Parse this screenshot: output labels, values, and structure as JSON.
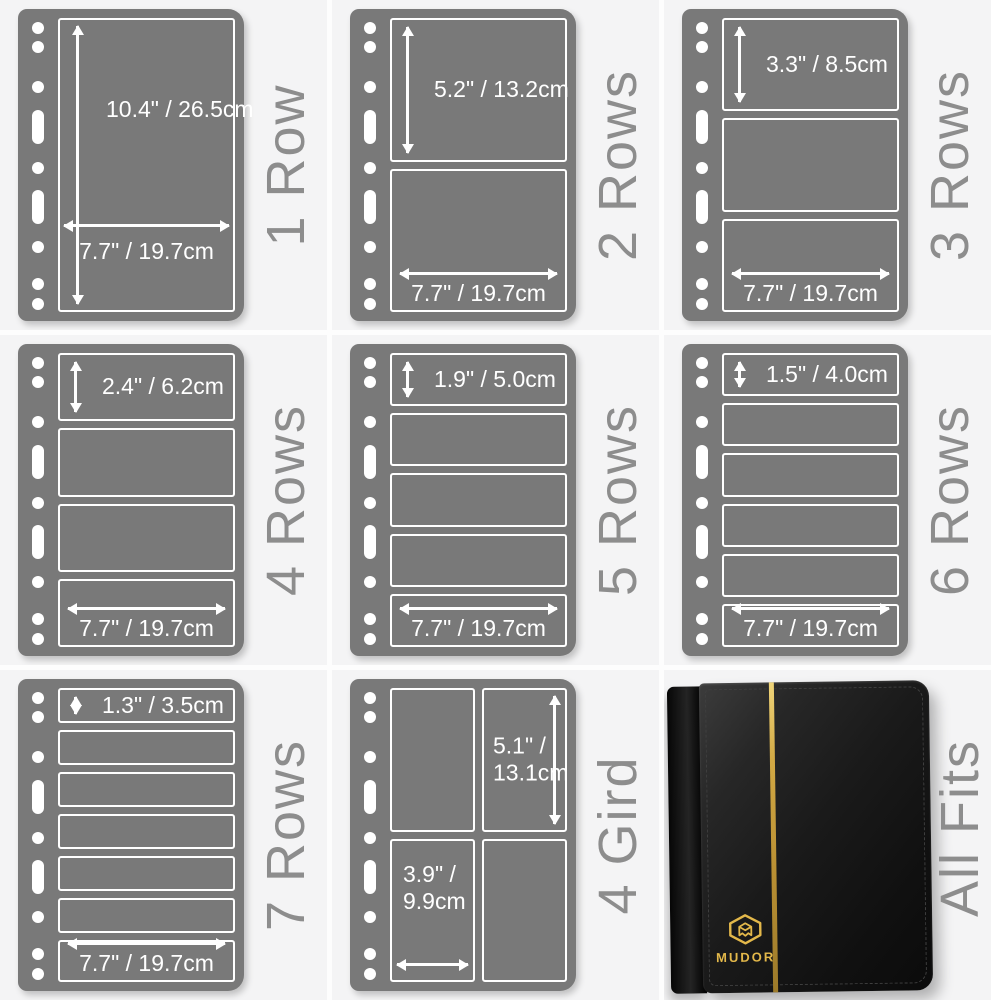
{
  "image_type": "stamp pocket page size infographic",
  "colors": {
    "page_gray": "#797979",
    "pocket_outline": "#ffffff",
    "measure_text": "#ffffff",
    "side_label_gray": "#8d8d8d",
    "tile_background": "#f4f4f5",
    "binder_black": "#141414",
    "binder_gold": "#e3b84a"
  },
  "icons": {
    "dimension_arrow": "white double-headed arrow",
    "punch_hole": "white binder punch hole (circle / slot)",
    "brand_logo": "gold isometric cube monogram"
  },
  "panels": [
    {
      "label": "1 Row",
      "rows": 1,
      "height_label": "10.4\" / 26.5cm",
      "width_label": "7.7\" / 19.7cm"
    },
    {
      "label": "2 Rows",
      "rows": 2,
      "height_label": "5.2\" / 13.2cm",
      "width_label": "7.7\" / 19.7cm"
    },
    {
      "label": "3 Rows",
      "rows": 3,
      "height_label": "3.3\" / 8.5cm",
      "width_label": "7.7\" / 19.7cm"
    },
    {
      "label": "4 Rows",
      "rows": 4,
      "height_label": "2.4\" / 6.2cm",
      "width_label": "7.7\" / 19.7cm"
    },
    {
      "label": "5 Rows",
      "rows": 5,
      "height_label": "1.9\" / 5.0cm",
      "width_label": "7.7\" / 19.7cm"
    },
    {
      "label": "6 Rows",
      "rows": 6,
      "height_label": "1.5\" / 4.0cm",
      "width_label": "7.7\" / 19.7cm"
    },
    {
      "label": "7 Rows",
      "rows": 7,
      "height_label": "1.3\" / 3.5cm",
      "width_label": "7.7\" / 19.7cm"
    },
    {
      "label": "4 Gird",
      "rows": 4,
      "grid": "2x2",
      "height_label_line1": "5.1\" /",
      "height_label_line2": "13.1cm",
      "width_label_line1": "3.9\" /",
      "width_label_line2": "9.9cm"
    },
    {
      "label": "All Fits",
      "brand": "MUDOR"
    }
  ]
}
